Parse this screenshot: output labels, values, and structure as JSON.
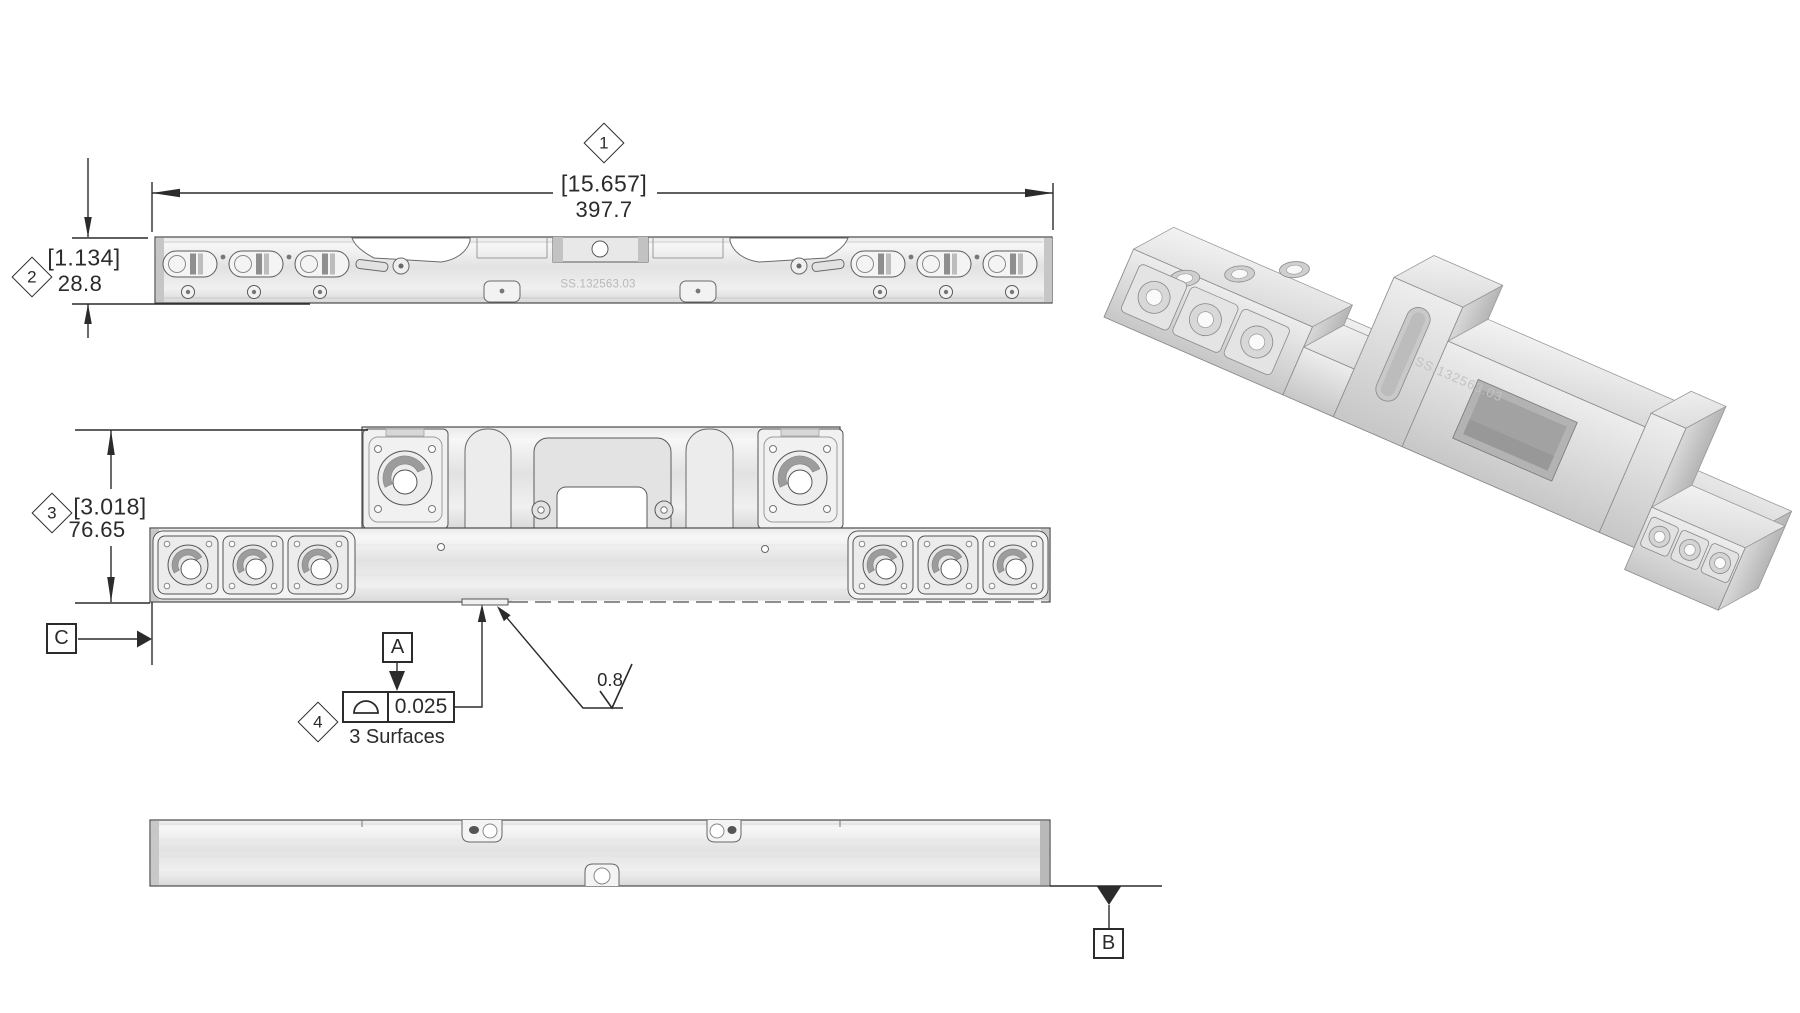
{
  "part": {
    "engraved_number": "SS.132563.03"
  },
  "balloons": {
    "b1": "1",
    "b2": "2",
    "b3": "3",
    "b4": "4"
  },
  "dimensions": {
    "length": {
      "inch": "[15.657]",
      "mm": "397.7"
    },
    "thickness": {
      "inch": "[1.134]",
      "mm": "28.8"
    },
    "height": {
      "inch": "[3.018]",
      "mm": "76.65"
    }
  },
  "datums": {
    "a": "A",
    "b": "B",
    "c": "C"
  },
  "tolerance": {
    "value": "0.025",
    "note": "3 Surfaces"
  },
  "surface_finish": {
    "roughness": "0.8"
  },
  "colors": {
    "line": "#2b2b2b",
    "metal_light": "#f6f6f6",
    "metal_mid": "#e2e2e2",
    "metal_dark": "#c6c6c6",
    "engraving": "#b8b8b8"
  }
}
